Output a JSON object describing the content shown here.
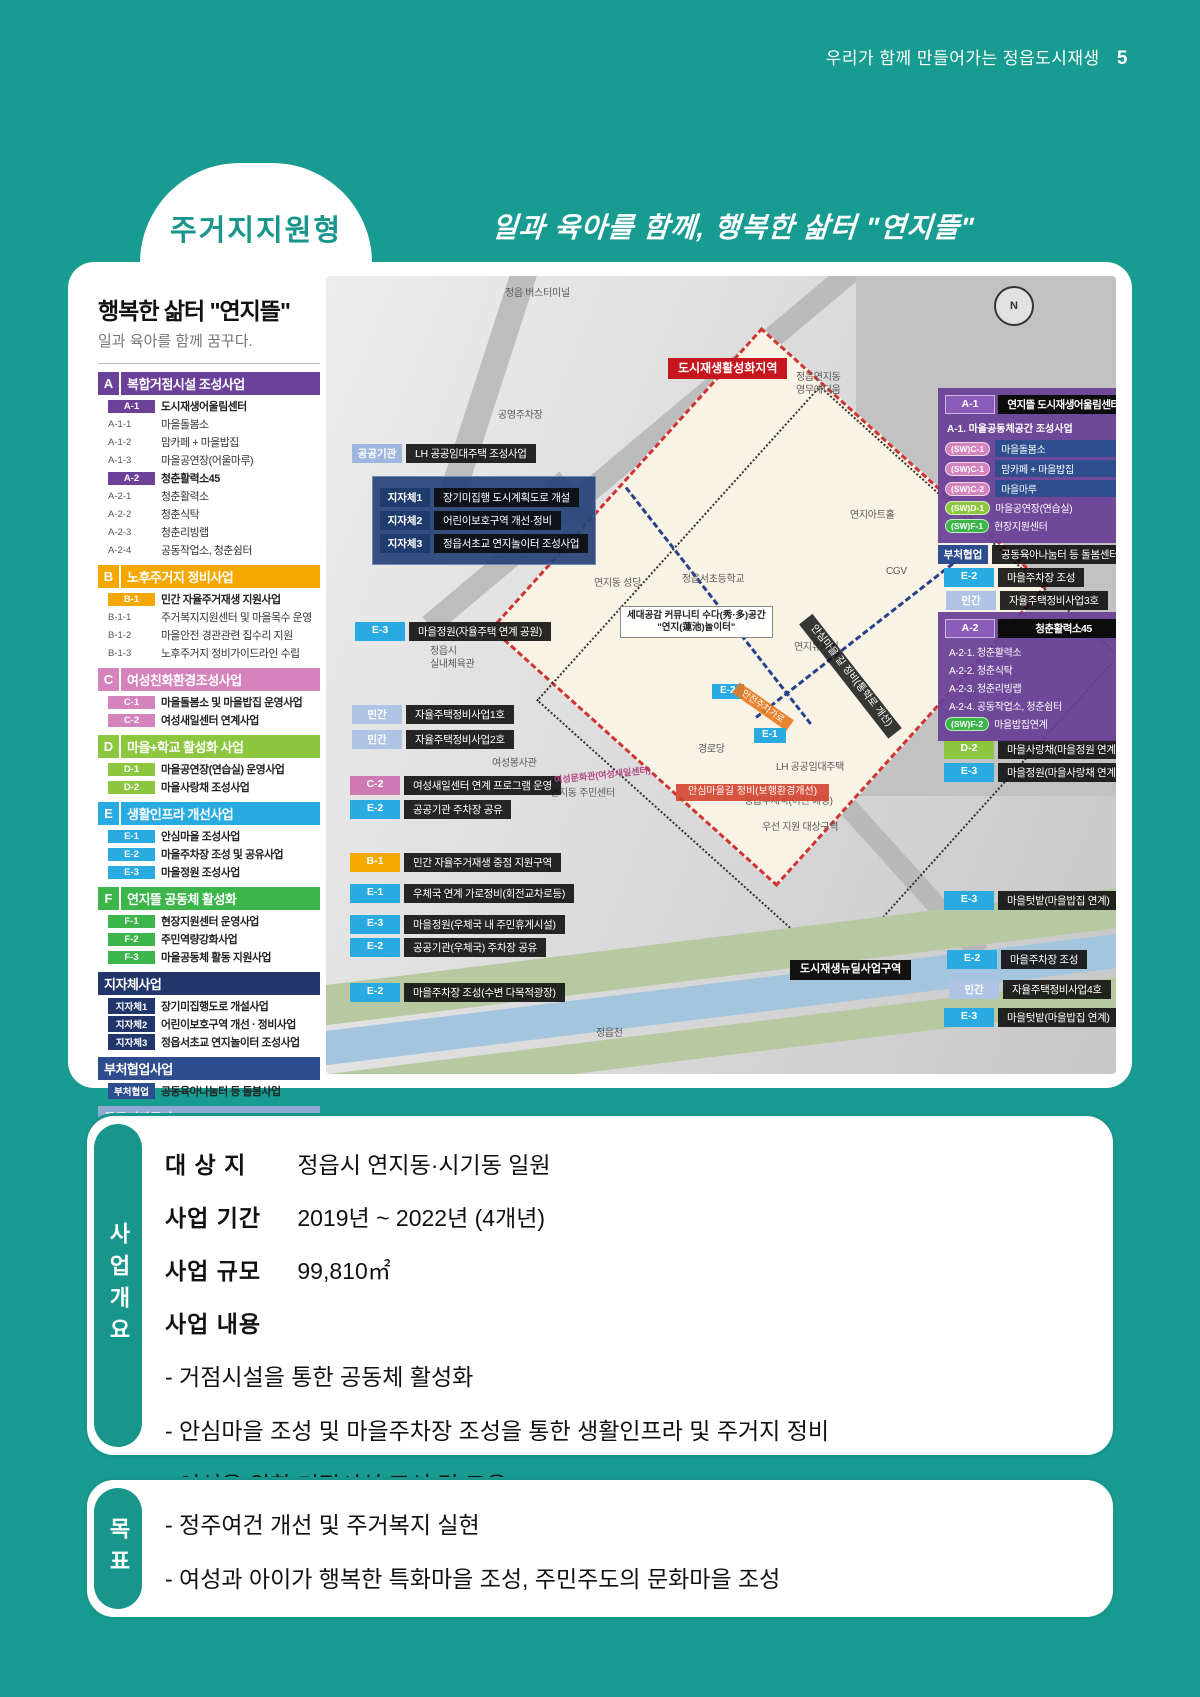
{
  "page": {
    "header_title": "우리가 함께 만들어가는 정읍도시재생",
    "page_number": "5",
    "badge": "주거지지원형",
    "tagline": "일과 육아를 함께, 행복한 삶터 \"연지뜰\"",
    "accent_color": "#189C91"
  },
  "legend": {
    "title": "행복한 삶터 \"연지뜰\"",
    "subtitle": "일과 육아를 함께 꿈꾸다.",
    "sections": [
      {
        "letter": "A",
        "color": "#6B4098",
        "title": "복합거점시설 조성사업",
        "items": [
          {
            "code": "A-1",
            "chip": true,
            "label": "도시재생어울림센터"
          },
          {
            "code": "A-1-1",
            "label": "마을돌봄소"
          },
          {
            "code": "A-1-2",
            "label": "맘카페 + 마을밥집"
          },
          {
            "code": "A-1-3",
            "label": "마을공연장(어울마루)"
          },
          {
            "code": "A-2",
            "chip": true,
            "label": "청춘활력소45"
          },
          {
            "code": "A-2-1",
            "label": "청춘활력소"
          },
          {
            "code": "A-2-2",
            "label": "청춘식탁"
          },
          {
            "code": "A-2-3",
            "label": "청춘리빙랩"
          },
          {
            "code": "A-2-4",
            "label": "공동작업소, 청춘쉼터"
          }
        ]
      },
      {
        "letter": "B",
        "color": "#F5A800",
        "title": "노후주거지 정비사업",
        "items": [
          {
            "code": "B-1",
            "chip": true,
            "label": "민간 자율주거재생 지원사업"
          },
          {
            "code": "B-1-1",
            "label": "주거복지지원센터 및 마을목수 운영"
          },
          {
            "code": "B-1-2",
            "label": "마을안전 경관관련 집수리 지원"
          },
          {
            "code": "B-1-3",
            "label": "노후주거지 정비가이드라인 수립"
          }
        ]
      },
      {
        "letter": "C",
        "color": "#D583BD",
        "title": "여성친화환경조성사업",
        "items": [
          {
            "code": "C-1",
            "chip": true,
            "label": "마을돌봄소 및 마을밥집 운영사업"
          },
          {
            "code": "C-2",
            "chip": true,
            "label": "여성새일센터 연계사업"
          }
        ]
      },
      {
        "letter": "D",
        "color": "#8DC63F",
        "title": "마을+학교 활성화 사업",
        "items": [
          {
            "code": "D-1",
            "chip": true,
            "label": "마을공연장(연습실) 운영사업"
          },
          {
            "code": "D-2",
            "chip": true,
            "label": "마을사랑채 조성사업"
          }
        ]
      },
      {
        "letter": "E",
        "color": "#29ABE2",
        "title": "생활인프라 개선사업",
        "items": [
          {
            "code": "E-1",
            "chip": true,
            "label": "안심마을 조성사업"
          },
          {
            "code": "E-2",
            "chip": true,
            "label": "마을주차장 조성 및 공유사업"
          },
          {
            "code": "E-3",
            "chip": true,
            "label": "마을정원 조성사업"
          }
        ]
      },
      {
        "letter": "F",
        "color": "#3CB54A",
        "title": "연지뜰 공동체 활성화",
        "items": [
          {
            "code": "F-1",
            "chip": true,
            "label": "현장지원센터 운영사업"
          },
          {
            "code": "F-2",
            "chip": true,
            "label": "주민역량강화사업"
          },
          {
            "code": "F-3",
            "chip": true,
            "label": "마을공동체 활동 지원사업"
          }
        ]
      },
      {
        "letter": "",
        "color": "#23366B",
        "title": "지자체사업",
        "items": [
          {
            "code": "지자체1",
            "chip": true,
            "cc": "#23366B",
            "label": "장기미집행도로 개설사업"
          },
          {
            "code": "지자체2",
            "chip": true,
            "cc": "#23366B",
            "label": "어린이보호구역 개선 · 정비사업"
          },
          {
            "code": "지자체3",
            "chip": true,
            "cc": "#23366B",
            "label": "정읍서초교 연지놀이터 조성사업"
          }
        ]
      },
      {
        "letter": "",
        "color": "#2E4D8E",
        "title": "부처협업사업",
        "items": [
          {
            "code": "부처협업",
            "chip": true,
            "cc": "#2E4D8E",
            "label": "공동육아나눔터 등 돌봄사업"
          }
        ]
      },
      {
        "letter": "",
        "color": "#8FA8D0",
        "title": "공공기관투자",
        "items": [
          {
            "code": "공공기관",
            "chip": true,
            "cc": "#9FB6DD",
            "label": "LH 공공임대주택 조성사업"
          }
        ]
      },
      {
        "letter": "",
        "color": "#A9BDDC",
        "title": "민간투자",
        "items": [
          {
            "code": "민간",
            "chip": true,
            "cc": "#AFC4E4",
            "label": "자율주택정비사업"
          }
        ]
      }
    ]
  },
  "map": {
    "compass": "N",
    "callouts": [
      {
        "code": "공공기관",
        "c": "#9FB6DD",
        "label": "LH 공공임대주택 조성사업",
        "x": 26,
        "y": 168
      },
      {
        "code": "E-3",
        "c": "#29ABE2",
        "label": "마을정원(자율주택 연계 공원)",
        "x": 29,
        "y": 346
      },
      {
        "code": "민간",
        "c": "#AFC4E4",
        "label": "자율주택정비사업1호",
        "x": 26,
        "y": 429
      },
      {
        "code": "민간",
        "c": "#AFC4E4",
        "label": "자율주택정비사업2호",
        "x": 26,
        "y": 454
      },
      {
        "code": "C-2",
        "c": "#CE79B4",
        "label": "여성새일센터 연계 프로그램 운영",
        "x": 24,
        "y": 500
      },
      {
        "code": "E-2",
        "c": "#29ABE2",
        "label": "공공기관 주차장 공유",
        "x": 24,
        "y": 524
      },
      {
        "code": "B-1",
        "c": "#F5A800",
        "label": "민간 자율주거재생 중점 지원구역",
        "x": 24,
        "y": 577
      },
      {
        "code": "E-1",
        "c": "#29ABE2",
        "label": "우체국 연계 가로정비(회전교차로등)",
        "x": 24,
        "y": 608
      },
      {
        "code": "E-3",
        "c": "#29ABE2",
        "label": "마을정원(우체국 내 주민휴게시설)",
        "x": 24,
        "y": 639
      },
      {
        "code": "E-2",
        "c": "#29ABE2",
        "label": "공공기관(우체국) 주차장 공유",
        "x": 24,
        "y": 662
      },
      {
        "code": "E-2",
        "c": "#29ABE2",
        "label": "마을주차장 조성(수변 다목적광장)",
        "x": 24,
        "y": 707
      },
      {
        "code": "부처협업",
        "c": "#2E4D8E",
        "label": "공동육아나눔터 등 돌봄센터",
        "x": 612,
        "y": 269
      },
      {
        "code": "E-2",
        "c": "#29ABE2",
        "label": "마을주차장 조성",
        "x": 618,
        "y": 292
      },
      {
        "code": "민간",
        "c": "#AFC4E4",
        "label": "자율주택정비사업3호",
        "x": 620,
        "y": 315
      },
      {
        "code": "D-2",
        "c": "#8DC63F",
        "label": "마을사랑채(마을정원 연계)",
        "x": 618,
        "y": 464
      },
      {
        "code": "E-3",
        "c": "#29ABE2",
        "label": "마을정원(마을사랑채 연계)",
        "x": 618,
        "y": 487
      },
      {
        "code": "E-3",
        "c": "#29ABE2",
        "label": "마을텃밭(마을밥집 연계)",
        "x": 618,
        "y": 615
      },
      {
        "code": "E-2",
        "c": "#29ABE2",
        "label": "마을주차장 조성",
        "x": 621,
        "y": 674
      },
      {
        "code": "민간",
        "c": "#AFC4E4",
        "label": "자율주택정비사업4호",
        "x": 623,
        "y": 704
      },
      {
        "code": "E-3",
        "c": "#29ABE2",
        "label": "마을텃밭(마을밥집 연계)",
        "x": 618,
        "y": 732
      }
    ],
    "muni_box": {
      "x": 46,
      "y": 200,
      "rows": [
        {
          "code": "지자체1",
          "label": "장기미집행 도시계획도로 개설"
        },
        {
          "code": "지자체2",
          "label": "어린이보호구역 개선·정비"
        },
        {
          "code": "지자체3",
          "label": "정읍서초교 연지놀이터 조성사업"
        }
      ]
    },
    "panel_a1": {
      "x": 612,
      "y": 112,
      "code": "A-1",
      "title": "연지뜰 도시재생어울림센터",
      "subtitle": "A-1. 마을공동체공간 조성사업",
      "items": [
        {
          "pill": "(SW)C-1",
          "c": "#D583BD",
          "label": "마을돌봄소",
          "barbg": true
        },
        {
          "pill": "(SW)C-1",
          "c": "#D583BD",
          "label": "맘카페 + 마을밥집",
          "barbg": true
        },
        {
          "pill": "(SW)C-2",
          "c": "#D583BD",
          "label": "마을마루",
          "barbg": true
        },
        {
          "pill": "(SW)D-1",
          "c": "#8DC63F",
          "label": "마을공연장(연습실)"
        },
        {
          "pill": "(SW)F-1",
          "c": "#3CB54A",
          "label": "현장지원센터"
        }
      ]
    },
    "panel_a2": {
      "x": 612,
      "y": 336,
      "code": "A-2",
      "title": "청춘활력소45",
      "lines": [
        "A-2-1. 청춘활력소",
        "A-2-2. 청춘식탁",
        "A-2-3. 청춘리빙랩",
        "A-2-4. 공동작업소, 청춘쉼터"
      ],
      "pill": {
        "pill": "(SW)F-2",
        "c": "#3CB54A",
        "label": "마을밥집연계"
      }
    },
    "labels": [
      {
        "t": "정읍 버스터미널",
        "x": 179,
        "y": 12,
        "type": "plain"
      },
      {
        "t": "공영주차장",
        "x": 172,
        "y": 134,
        "type": "plain"
      },
      {
        "t": "도시재생활성화지역",
        "x": 342,
        "y": 82,
        "type": "red"
      },
      {
        "t": "정읍연지동\n영무예디움",
        "x": 470,
        "y": 96,
        "type": "plain"
      },
      {
        "t": "연지아트홀",
        "x": 524,
        "y": 234,
        "type": "plain"
      },
      {
        "t": "CGV",
        "x": 560,
        "y": 290,
        "type": "plain"
      },
      {
        "t": "연지동 성당",
        "x": 268,
        "y": 302,
        "type": "plain"
      },
      {
        "t": "정읍서초등학교",
        "x": 356,
        "y": 298,
        "type": "plain"
      },
      {
        "t": "세대공감 커뮤니티 수다(秀·多)공간\n\"연지(蓮池)놀이터\"",
        "x": 294,
        "y": 330,
        "type": "white"
      },
      {
        "t": "연지유치원",
        "x": 468,
        "y": 366,
        "type": "plain"
      },
      {
        "t": "정읍시\n실내체육관",
        "x": 104,
        "y": 370,
        "type": "plain"
      },
      {
        "t": "안심마을 길 정비(통학로 개선)",
        "x": 452,
        "y": 392,
        "type": "dark",
        "rot": 52
      },
      {
        "t": "E-2",
        "x": 386,
        "y": 408,
        "type": "chip",
        "c": "#29ABE2"
      },
      {
        "t": "안전주차가로",
        "x": 404,
        "y": 424,
        "type": "orangebar",
        "rot": 35
      },
      {
        "t": "여성봉사관",
        "x": 166,
        "y": 482,
        "type": "plain"
      },
      {
        "t": "여성문화관(여성새일센터)",
        "x": 228,
        "y": 494,
        "type": "pink",
        "rot": -6
      },
      {
        "t": "연지동 주민센터",
        "x": 224,
        "y": 512,
        "type": "plain"
      },
      {
        "t": "경로당",
        "x": 372,
        "y": 468,
        "type": "plain"
      },
      {
        "t": "E-1",
        "x": 428,
        "y": 452,
        "type": "chip",
        "c": "#29ABE2"
      },
      {
        "t": "LH 공공임대주택",
        "x": 450,
        "y": 486,
        "type": "plain"
      },
      {
        "t": "안심마을길 정비(보행환경개선)",
        "x": 350,
        "y": 508,
        "type": "redbar"
      },
      {
        "t": "정읍우체국(이전 예정)",
        "x": 418,
        "y": 520,
        "type": "plain"
      },
      {
        "t": "우선 지원 대상구역",
        "x": 436,
        "y": 546,
        "type": "plain"
      },
      {
        "t": "도시재생뉴딜사업구역",
        "x": 464,
        "y": 684,
        "type": "black"
      },
      {
        "t": "정읍천",
        "x": 270,
        "y": 752,
        "type": "plain"
      }
    ]
  },
  "overview": {
    "tab": "사업개요",
    "rows": [
      {
        "label": "대 상 지",
        "value": "정읍시 연지동·시기동 일원"
      },
      {
        "label": "사업 기간",
        "value": "2019년 ~ 2022년 (4개년)"
      },
      {
        "label": "사업 규모",
        "value": "99,810㎡"
      },
      {
        "label": "사업 내용",
        "value": ""
      }
    ],
    "bullets": [
      "- 거점시설을 통한 공동체 활성화",
      "- 안심마을 조성 및 마을주차장 조성을 통한 생활인프라 및 주거지 정비",
      "- 여성을 위한 거점시설 조성 및 교육"
    ]
  },
  "goal": {
    "tab": "목표",
    "bullets": [
      "- 정주여건 개선 및 주거복지 실현",
      "- 여성과 아이가 행복한 특화마을 조성, 주민주도의 문화마을 조성"
    ]
  }
}
